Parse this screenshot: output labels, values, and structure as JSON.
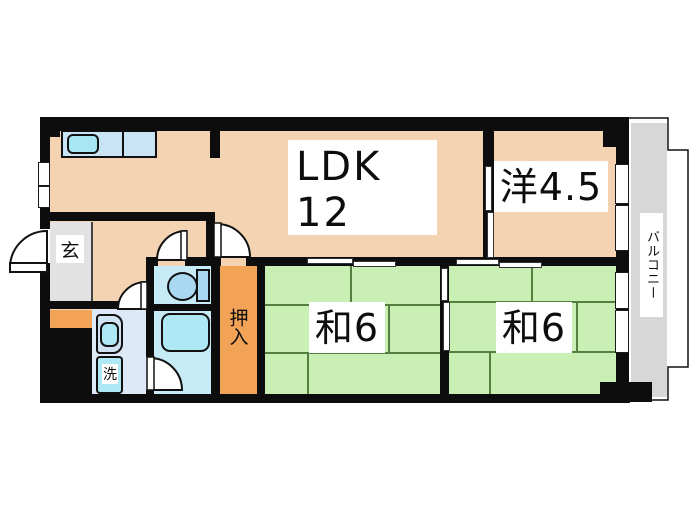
{
  "labels": {
    "ldk_line1": "LDK",
    "ldk_line2": "12",
    "western_room": "洋4.5",
    "japanese_room_1": "和6",
    "japanese_room_2": "和6",
    "entrance": "玄",
    "closet": "押入",
    "laundry": "洗",
    "balcony": "バルコニー"
  },
  "colors": {
    "room_peach": "#f4d3b3",
    "tatami_green": "#c9efb4",
    "closet_orange": "#f2a356",
    "entrance_gray": "#e2e2e2",
    "balcony_gray": "#d7d7d7",
    "wet_area_blue": "#c6ebf7",
    "washroom_blue": "#dde9f7",
    "fixture_cyan": "#aee8f4",
    "wall_black": "#0d0d0d"
  }
}
